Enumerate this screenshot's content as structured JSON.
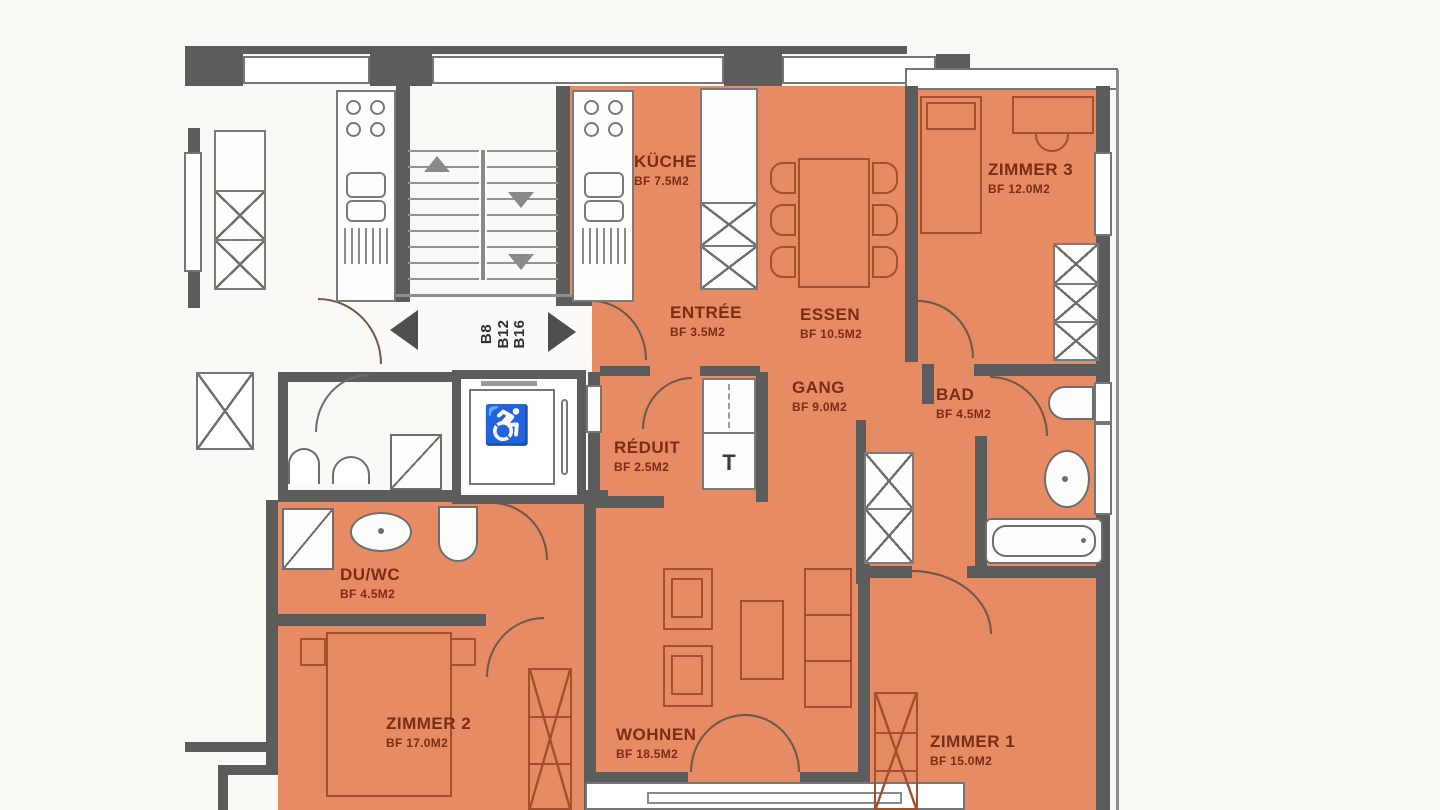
{
  "plan_type": "apartment-floor-plan",
  "unit": {
    "lines": [
      "B8",
      "B12",
      "B16"
    ]
  },
  "rooms": [
    {
      "id": "kueche",
      "name": "KÜCHE",
      "area": "BF 7.5M2"
    },
    {
      "id": "entree",
      "name": "ENTRÉE",
      "area": "BF 3.5M2"
    },
    {
      "id": "essen",
      "name": "ESSEN",
      "area": "BF 10.5M2"
    },
    {
      "id": "zimmer3",
      "name": "ZIMMER 3",
      "area": "BF 12.0M2"
    },
    {
      "id": "gang",
      "name": "GANG",
      "area": "BF 9.0M2"
    },
    {
      "id": "bad",
      "name": "BAD",
      "area": "BF 4.5M2"
    },
    {
      "id": "reduit",
      "name": "RÉDUIT",
      "area": "BF 2.5M2"
    },
    {
      "id": "duwc",
      "name": "DU/WC",
      "area": "BF 4.5M2"
    },
    {
      "id": "zimmer2",
      "name": "ZIMMER 2",
      "area": "BF 17.0M2"
    },
    {
      "id": "wohnen",
      "name": "WOHNEN",
      "area": "BF 18.5M2"
    },
    {
      "id": "zimmer1",
      "name": "ZIMMER 1",
      "area": "BF 15.0M2"
    }
  ],
  "markers": {
    "tumbler": "T"
  },
  "icons": {
    "wheelchair": "♿"
  },
  "colors": {
    "apartment_fill": "#e68b63",
    "wall": "#5c5c5c",
    "label_text": "#7b2c15",
    "furniture_outline": "#a2512c",
    "background": "#faf9f6"
  }
}
